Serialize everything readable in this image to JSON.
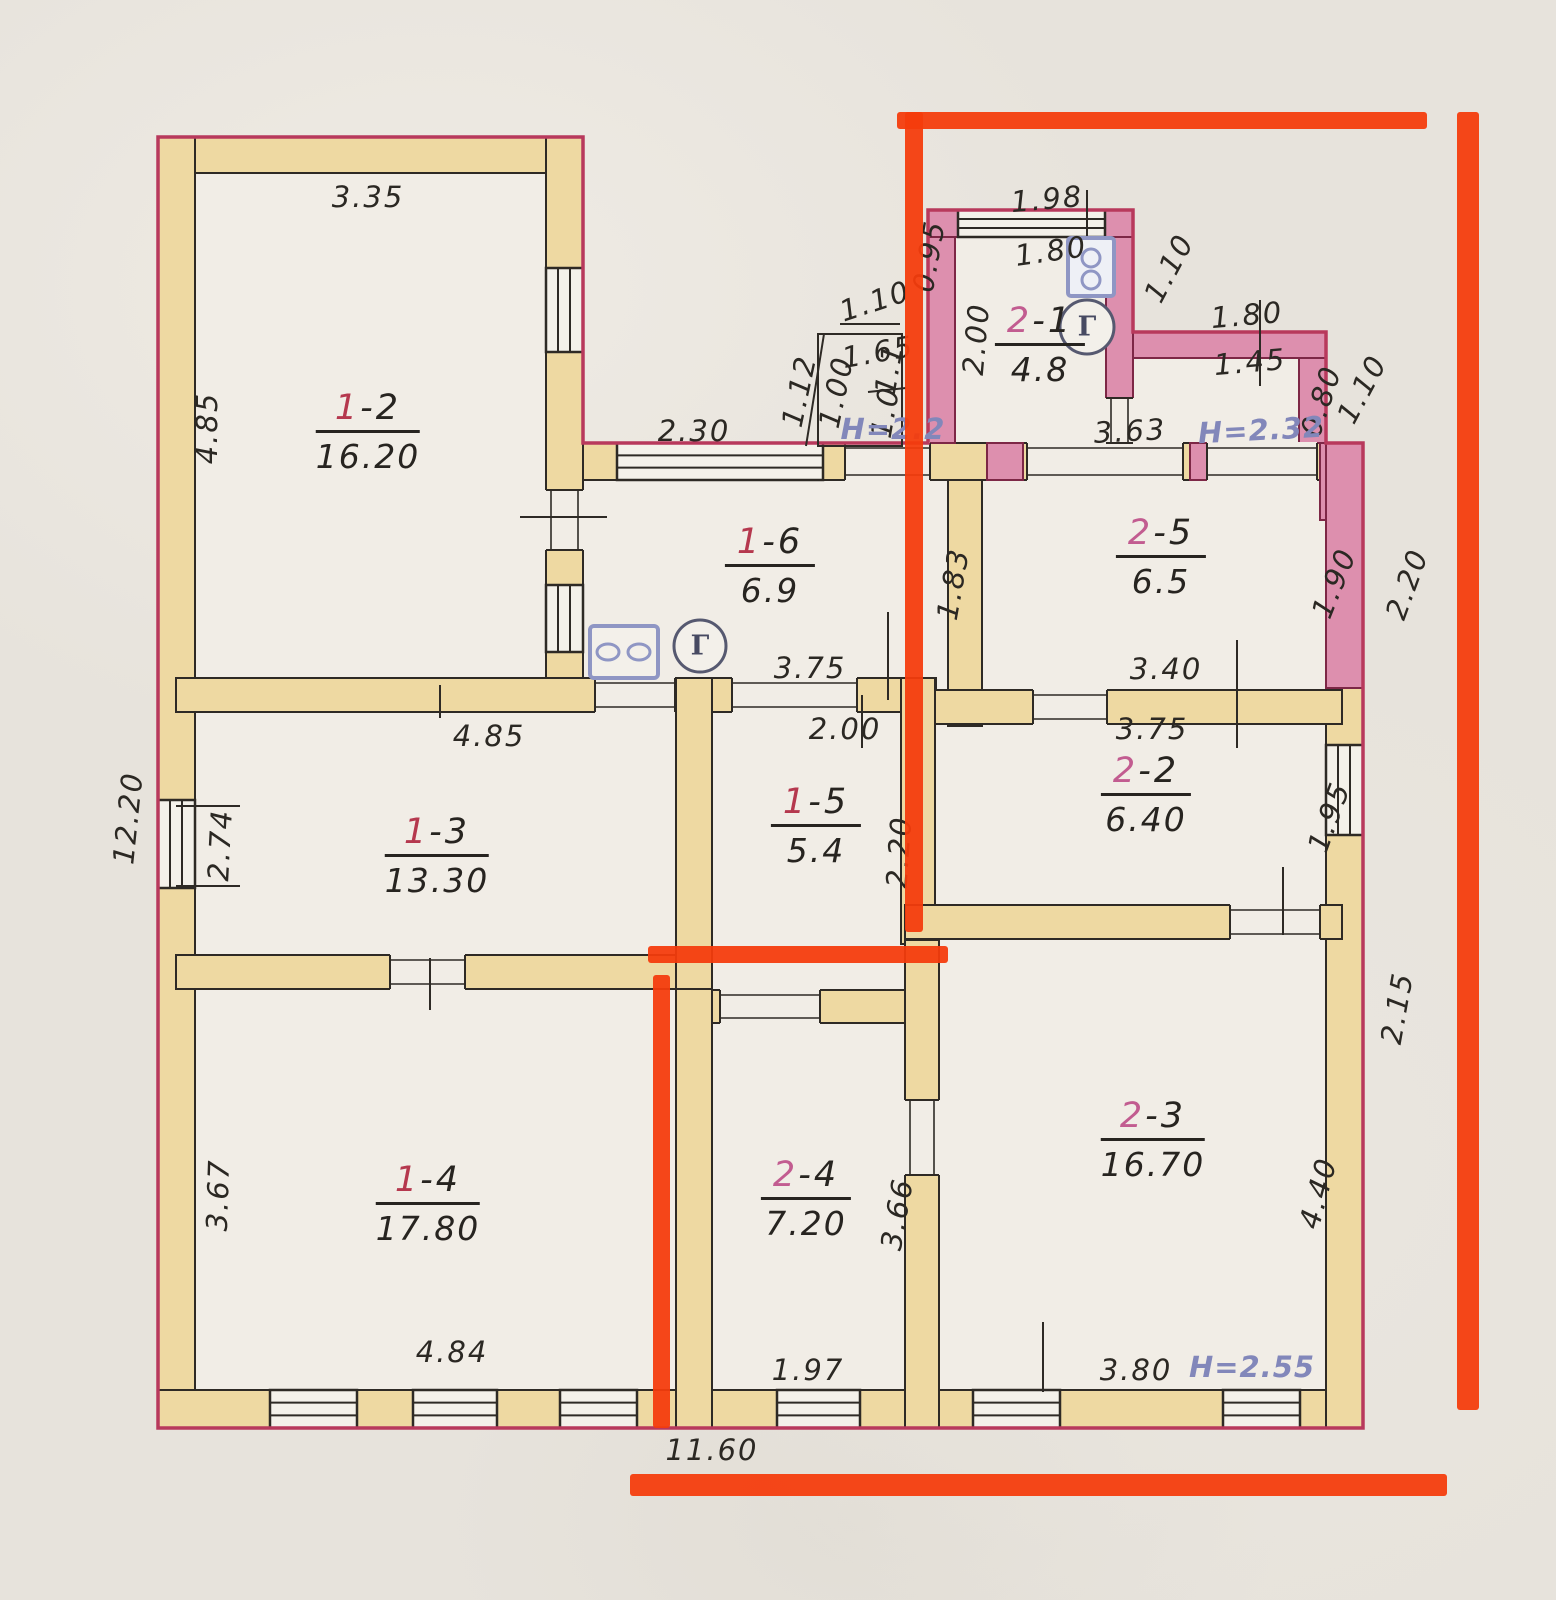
{
  "document": {
    "type": "scanned floor plan with red marker annotations",
    "sections_present": [
      "1",
      "2"
    ]
  },
  "palette": {
    "paper": "#e7e3dc",
    "room_interior": "#f1ede6",
    "wall_fill_yellow": "#eed9a2",
    "wall_fill_pink": "#dd8fae",
    "ink_line": "#2e2a25",
    "crimson_outline": "#b8395c",
    "marker_red": "#f43b0c",
    "blue_note": "#8287ba",
    "section1_accent": "#b5384e",
    "section2_accent": "#c25c90"
  },
  "rooms": [
    {
      "sec": "1",
      "suffix": "-2",
      "area": "16.20",
      "x": 368,
      "y": 432
    },
    {
      "sec": "1",
      "suffix": "-3",
      "area": "13.30",
      "x": 437,
      "y": 856
    },
    {
      "sec": "1",
      "suffix": "-4",
      "area": "17.80",
      "x": 428,
      "y": 1204
    },
    {
      "sec": "1",
      "suffix": "-5",
      "area": "5.4",
      "x": 816,
      "y": 826
    },
    {
      "sec": "1",
      "suffix": "-6",
      "area": "6.9",
      "x": 770,
      "y": 566
    },
    {
      "sec": "2",
      "suffix": "-1",
      "area": "4.8",
      "x": 1040,
      "y": 345
    },
    {
      "sec": "2",
      "suffix": "-2",
      "area": "6.40",
      "x": 1146,
      "y": 795
    },
    {
      "sec": "2",
      "suffix": "-3",
      "area": "16.70",
      "x": 1153,
      "y": 1140
    },
    {
      "sec": "2",
      "suffix": "-4",
      "area": "7.20",
      "x": 806,
      "y": 1199
    },
    {
      "sec": "2",
      "suffix": "-5",
      "area": "6.5",
      "x": 1161,
      "y": 557
    }
  ],
  "dimensions": [
    {
      "text": "3.35",
      "x": 368,
      "y": 197,
      "rot": 0
    },
    {
      "text": "4.85",
      "x": 207,
      "y": 428,
      "rot": -90
    },
    {
      "text": "12.20",
      "x": 128,
      "y": 818,
      "rot": -84
    },
    {
      "text": "2.74",
      "x": 220,
      "y": 845,
      "rot": -87
    },
    {
      "text": "3.67",
      "x": 218,
      "y": 1195,
      "rot": -88
    },
    {
      "text": "4.84",
      "x": 452,
      "y": 1352,
      "rot": 0
    },
    {
      "text": "11.60",
      "x": 712,
      "y": 1450,
      "rot": 0
    },
    {
      "text": "2.30",
      "x": 694,
      "y": 431,
      "rot": 0
    },
    {
      "text": "1.12",
      "x": 799,
      "y": 391,
      "rot": -78
    },
    {
      "text": "1.00",
      "x": 836,
      "y": 392,
      "rot": -78
    },
    {
      "text": "1.10",
      "x": 875,
      "y": 301,
      "rot": -18
    },
    {
      "text": "1.65",
      "x": 878,
      "y": 352,
      "rot": -10
    },
    {
      "text": "1.1",
      "x": 889,
      "y": 369,
      "rot": -80
    },
    {
      "text": "1.0",
      "x": 885,
      "y": 412,
      "rot": -80
    },
    {
      "text": "1.98",
      "x": 1047,
      "y": 199,
      "rot": -5
    },
    {
      "text": "1.80",
      "x": 1051,
      "y": 251,
      "rot": -8
    },
    {
      "text": "0.95",
      "x": 929,
      "y": 256,
      "rot": -80
    },
    {
      "text": "1.10",
      "x": 1169,
      "y": 268,
      "rot": -62
    },
    {
      "text": "2.00",
      "x": 976,
      "y": 339,
      "rot": -85
    },
    {
      "text": "1.80",
      "x": 1247,
      "y": 315,
      "rot": -5
    },
    {
      "text": "1.45",
      "x": 1250,
      "y": 362,
      "rot": -5
    },
    {
      "text": "0.80",
      "x": 1321,
      "y": 401,
      "rot": -72
    },
    {
      "text": "1.10",
      "x": 1362,
      "y": 389,
      "rot": -62
    },
    {
      "text": "3.63",
      "x": 1130,
      "y": 431,
      "rot": -3
    },
    {
      "text": "1.83",
      "x": 953,
      "y": 584,
      "rot": -80
    },
    {
      "text": "1.90",
      "x": 1334,
      "y": 583,
      "rot": -68
    },
    {
      "text": "2.20",
      "x": 1407,
      "y": 584,
      "rot": -70
    },
    {
      "text": "3.40",
      "x": 1166,
      "y": 669,
      "rot": 0
    },
    {
      "text": "3.75",
      "x": 810,
      "y": 668,
      "rot": 0
    },
    {
      "text": "2.00",
      "x": 845,
      "y": 729,
      "rot": 0
    },
    {
      "text": "3.75",
      "x": 1152,
      "y": 729,
      "rot": 0
    },
    {
      "text": "4.85",
      "x": 489,
      "y": 736,
      "rot": 0
    },
    {
      "text": "1.95",
      "x": 1329,
      "y": 817,
      "rot": -70
    },
    {
      "text": "2.20",
      "x": 899,
      "y": 852,
      "rot": -86
    },
    {
      "text": "3.66",
      "x": 897,
      "y": 1214,
      "rot": -80
    },
    {
      "text": "4.40",
      "x": 1318,
      "y": 1193,
      "rot": -75
    },
    {
      "text": "2.15",
      "x": 1397,
      "y": 1008,
      "rot": -80
    },
    {
      "text": "3.80",
      "x": 1136,
      "y": 1370,
      "rot": 0
    },
    {
      "text": "1.97",
      "x": 808,
      "y": 1370,
      "rot": 0
    }
  ],
  "heights": [
    {
      "text": "H=2.2",
      "x": 893,
      "y": 429,
      "rot": 0
    },
    {
      "text": "H=2.32",
      "x": 1261,
      "y": 430,
      "rot": -3
    },
    {
      "text": "H=2.55",
      "x": 1252,
      "y": 1367,
      "rot": 0
    }
  ],
  "icons": [
    {
      "name": "gas-stove-icon"
    },
    {
      "name": "gas-meter-icon",
      "label": "Г",
      "x": 700,
      "y": 646
    },
    {
      "name": "water-heater-icon"
    },
    {
      "name": "gas-meter-icon",
      "label": "Г",
      "x": 1087,
      "y": 327
    }
  ]
}
